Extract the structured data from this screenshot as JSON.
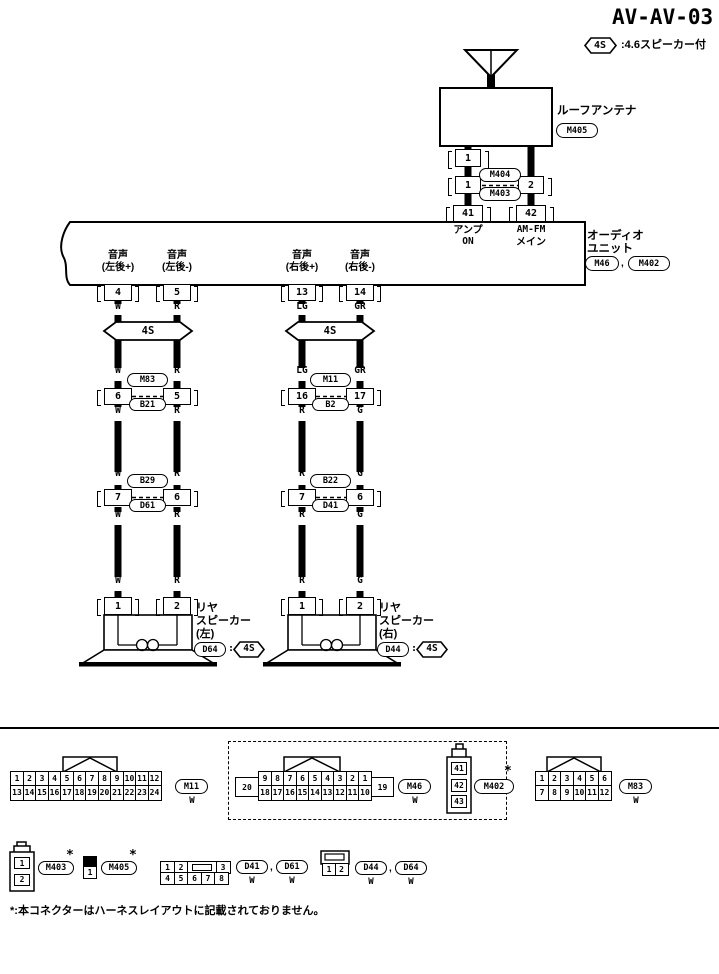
{
  "ink": "#000000",
  "paper": "#ffffff",
  "title": "AV-AV-03",
  "option_note": {
    "tag": "4S",
    "text": ":4.6スピーカー付"
  },
  "antenna": {
    "label": "ルーフアンテナ",
    "connector": "M405",
    "pin": "1"
  },
  "top_junction": {
    "pin_left": "1",
    "pin_right": "2",
    "upper": "M404",
    "lower": "M403"
  },
  "audio_unit": {
    "pin_amp": {
      "num": "41",
      "line1": "アンプ",
      "line2": "ON"
    },
    "pin_am_fm": {
      "num": "42",
      "line1": "AM-FM",
      "line2": "メイン"
    },
    "name_line1": "オーディオ",
    "name_line2": "ユニット",
    "conn1": "M46",
    "comma": ",",
    "conn2": "M402",
    "pins": [
      {
        "num": "4",
        "line1": "音声",
        "line2": "(左後+)"
      },
      {
        "num": "5",
        "line1": "音声",
        "line2": "(左後-)"
      },
      {
        "num": "13",
        "line1": "音声",
        "line2": "(右後+)"
      },
      {
        "num": "14",
        "line1": "音声",
        "line2": "(右後-)"
      }
    ]
  },
  "harness_tags": {
    "left": "4S",
    "right": "4S"
  },
  "wire_labels": {
    "col1": {
      "a": "W",
      "b": "W",
      "c": "W",
      "d": "W",
      "e": "W",
      "f": "W"
    },
    "col2": {
      "a": "R",
      "b": "R",
      "c": "R",
      "d": "R",
      "e": "R",
      "f": "R"
    },
    "col3": {
      "a": "LG",
      "b": "LG",
      "c": "R",
      "d": "R",
      "e": "R",
      "f": "R"
    },
    "col4": {
      "a": "GR",
      "b": "GR",
      "c": "G",
      "d": "G",
      "e": "G",
      "f": "G"
    }
  },
  "junction_row1": {
    "left": {
      "pin_l": "6",
      "pin_r": "5",
      "upper": "M83",
      "lower": "B21"
    },
    "right": {
      "pin_l": "16",
      "pin_r": "17",
      "upper": "M11",
      "lower": "B2"
    }
  },
  "junction_row2": {
    "left": {
      "pin_l": "7",
      "pin_r": "6",
      "upper": "B29",
      "lower": "D61"
    },
    "right": {
      "pin_l": "7",
      "pin_r": "6",
      "upper": "B22",
      "lower": "D41"
    }
  },
  "speaker_left": {
    "pin1": "1",
    "pin2": "2",
    "name1": "リヤ",
    "name2": "スピーカー",
    "name3": "(左)",
    "conn": "D64",
    "colon": ":",
    "tag": "4S"
  },
  "speaker_right": {
    "pin1": "1",
    "pin2": "2",
    "name1": "リヤ",
    "name2": "スピーカー",
    "name3": "(右)",
    "conn": "D44",
    "colon": ":",
    "tag": "4S"
  },
  "connector_views": {
    "m11": {
      "row1": [
        "1",
        "2",
        "3",
        "4",
        "5",
        "6",
        "7",
        "8",
        "9",
        "10",
        "11",
        "12"
      ],
      "row2": [
        "13",
        "14",
        "15",
        "16",
        "17",
        "18",
        "19",
        "20",
        "21",
        "22",
        "23",
        "24"
      ],
      "label": "M11",
      "color": "W"
    },
    "m46": {
      "cell_left": "20",
      "row1": [
        "9",
        "8",
        "7",
        "6",
        "5",
        "4",
        "3",
        "2",
        "1"
      ],
      "row2": [
        "18",
        "17",
        "16",
        "15",
        "14",
        "13",
        "12",
        "11",
        "10"
      ],
      "cell_right": "19",
      "label": "M46",
      "color": "W"
    },
    "m402": {
      "cells": [
        "41",
        "42",
        "43"
      ],
      "label": "M402",
      "star": "*"
    },
    "m83": {
      "row1": [
        "1",
        "2",
        "3",
        "4",
        "5",
        "6"
      ],
      "row2": [
        "7",
        "8",
        "9",
        "10",
        "11",
        "12"
      ],
      "label": "M83",
      "color": "W"
    },
    "m403": {
      "cells": [
        "1",
        "2"
      ],
      "label": "M403",
      "star": "*"
    },
    "m405": {
      "cell": "1",
      "label": "M405",
      "star": "*"
    },
    "d41_d61": {
      "row1a": [
        "1",
        "2"
      ],
      "row1b": [
        "3"
      ],
      "row2": [
        "4",
        "5",
        "6",
        "7",
        "8"
      ],
      "label1": "D41",
      "comma": ",",
      "label2": "D61",
      "color1": "W",
      "color2": "W"
    },
    "d44_d64": {
      "cells": [
        "1",
        "2"
      ],
      "label1": "D44",
      "comma": ",",
      "label2": "D64",
      "color1": "W",
      "color2": "W"
    }
  },
  "footer_note": "*:本コネクターはハーネスレイアウトに記載されておりません。"
}
